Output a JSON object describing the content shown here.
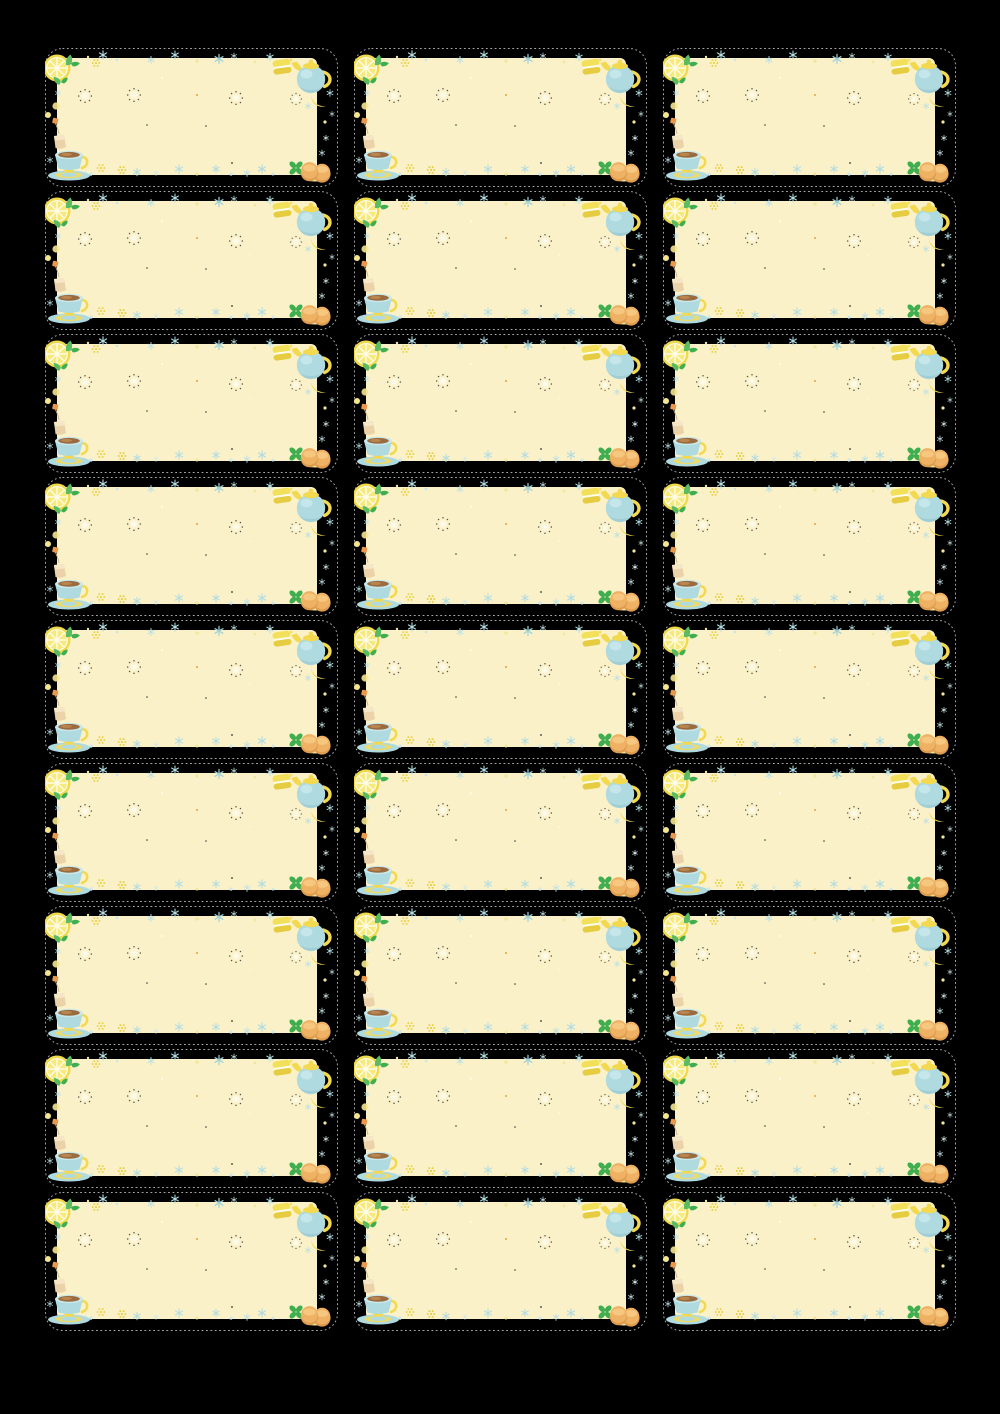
{
  "page": {
    "background": "#000000",
    "description_text": ""
  },
  "sheet": {
    "rows": 9,
    "columns": 3,
    "label_count": 27
  },
  "label": {
    "shape": "rounded-rectangle-with-dashed-cut-line",
    "text_content": "",
    "decorations": [
      "lemon-slice-icon",
      "mint-sprig-icon",
      "macaron-icon",
      "teapot-icon",
      "lemon-wedge-icon",
      "tea-bag-icon",
      "teacup-icon",
      "cookies-icon",
      "clover-leaf-icon",
      "snowflake-sparkle-icon",
      "dot-flower-sparkle-icon",
      "dotted-rosette-icon"
    ],
    "palette": {
      "bg": "#000000",
      "cut": "#a6a6a6",
      "panel": "#FBF1C9",
      "lemonRind": "#F0DA4C",
      "lemonFlesh": "#F6E97E",
      "lemonLine": "#FEFBE7",
      "leafGreen": "#5ABB60",
      "leafGreenDark": "#3FAE4F",
      "potBlue": "#AEDAE0",
      "potBlueLight": "#C9E8EB",
      "potBlueShade": "#9DCBD2",
      "accentYellow": "#F2D94F",
      "teaBrown": "#9A6B3F",
      "teaBrownLight": "#BA8650",
      "cookie": "#EFB265",
      "cookieDark": "#DE9C4F",
      "cookieLight": "#F6C87F",
      "bagTan": "#EBD2A8",
      "bagTanLight": "#F4E6C6",
      "tagOrange": "#E9984E",
      "snowBlue": "#AFDCE2",
      "paleYellow": "#F3E79E"
    }
  }
}
